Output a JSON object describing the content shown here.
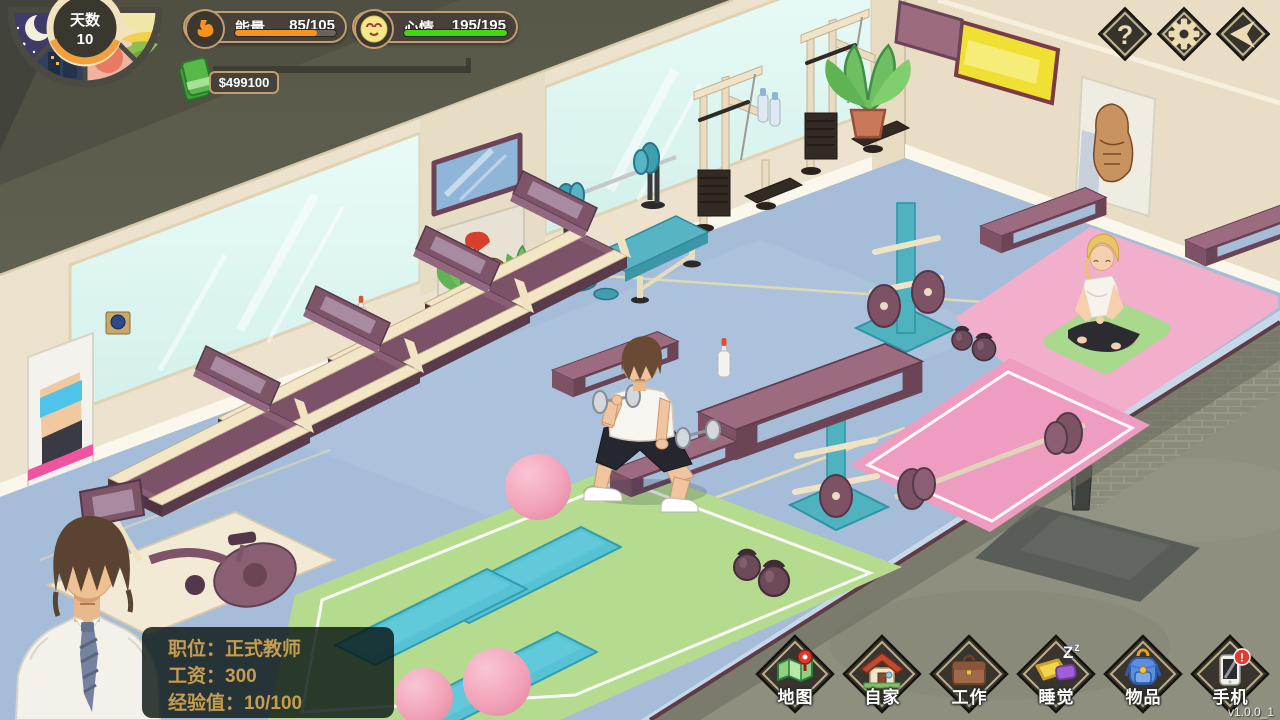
{
  "hud": {
    "day": {
      "label": "天数",
      "value": "10"
    },
    "energy": {
      "label": "能量",
      "value": "85/105",
      "percent": 81,
      "color": "#f7941d"
    },
    "mood": {
      "label": "心情",
      "value": "195/195",
      "percent": 100,
      "color": "#46d416"
    },
    "money": {
      "value": "$499100"
    }
  },
  "top_buttons": {
    "help_label": "?"
  },
  "job_panel": {
    "lines": [
      "职位：正式教师",
      "工资：300",
      "经验值：10/100"
    ]
  },
  "nav": [
    {
      "id": "map",
      "label": "地图"
    },
    {
      "id": "home",
      "label": "自家"
    },
    {
      "id": "work",
      "label": "工作"
    },
    {
      "id": "sleep",
      "label": "睡觉",
      "icon_text_big": "Z",
      "icon_text_small": "z"
    },
    {
      "id": "items",
      "label": "物品"
    },
    {
      "id": "phone",
      "label": "手机",
      "badge": "!"
    }
  ],
  "version": "v1.0.0_1",
  "colors": {
    "ui_border": "#c19d6f",
    "ui_dark": "#474139",
    "energy_bar": "#f7941d",
    "mood_bar": "#46d416",
    "money_icon": "#58b84a",
    "floor_blue": "#a6bdd9",
    "wall_cream": "#ece2cd",
    "zone_pink": "#f2afcb",
    "platform_pink": "#ef9cc1",
    "zone_green": "#b5dc8e",
    "equipment_mauve": "#8a5f74",
    "equipment_teal": "#4fb3bf"
  }
}
